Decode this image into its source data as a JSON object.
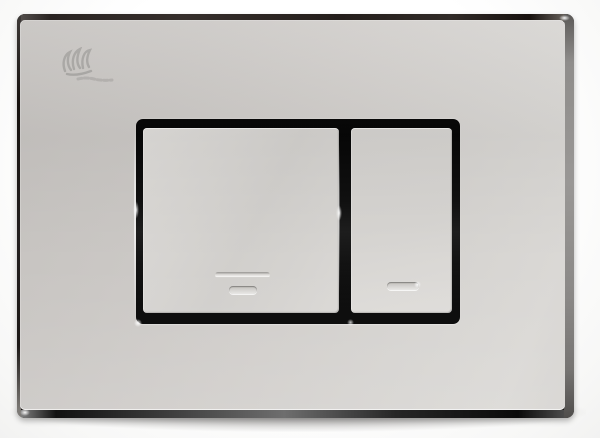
{
  "scene": {
    "type": "product-photo",
    "subject": "Polished chrome dual-flush toilet actuator wall plate, front view",
    "background_color": "#fafaf9"
  },
  "plate": {
    "finish": "polished chrome",
    "colors": {
      "face_highlight": "#dad8d5",
      "face_shadow": "#c5c2bf",
      "bevel_dark": "#1a1614",
      "side_gray": "#8f8d8b",
      "recess_black": "#0b0b0b",
      "engraving_shadow": "#a3a19e",
      "engraving_highlight": "#f1f0ee"
    },
    "logo": {
      "icon": "engraved-brand-mark",
      "text_legible": false
    },
    "buttons": [
      {
        "name": "full-flush-button",
        "position": "left",
        "relative_size": "large",
        "engraving": "one long double groove line above one short pill line"
      },
      {
        "name": "half-flush-button",
        "position": "right",
        "relative_size": "small",
        "engraving": "single short pill line"
      }
    ]
  },
  "a11y": {
    "caption": "Front view of a polished chrome dual-flush wall plate: a wide full-flush button on the left marked with two engraved horizontal lines, and a narrower half-flush button on the right marked with one engraved line, both set in a dark recessed frame."
  }
}
